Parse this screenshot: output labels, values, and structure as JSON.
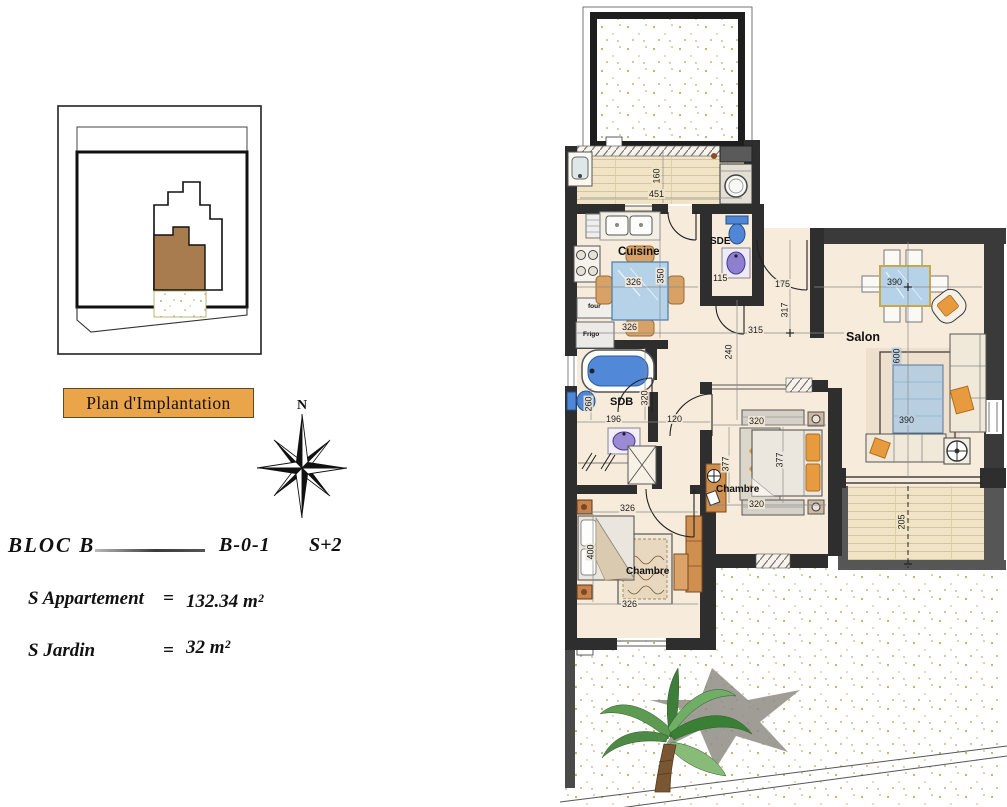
{
  "colors": {
    "caption_fill": "#EAA449",
    "wall_dark": "#2E2E2E",
    "wall_gray": "#565656",
    "floor_cream": "#F7ECDB",
    "deck_tan": "#F1E4C6",
    "water_blue": "#4F86D6",
    "glass_blue": "#B5D2E8",
    "wood_orange": "#CF8F4F",
    "cushion_orange": "#E79B3E",
    "fixture_lavender": "#9A8BD4",
    "siteplan_brown": "#A87C4E",
    "leaf_green": "#4C8A45"
  },
  "site_plan": {
    "caption": "Plan d'Implantation"
  },
  "compass": {
    "north": "N"
  },
  "title_block": {
    "bloc": "BLOC B",
    "unit": "B-0-1",
    "level": "S+2",
    "areas": [
      {
        "label": "S  Appartement",
        "equals": "=",
        "value": "132.34 m²"
      },
      {
        "label": "S  Jardin",
        "equals": "=",
        "value": "32 m²"
      }
    ]
  },
  "plan": {
    "room_labels": {
      "cuisine": "Cuisine",
      "sde": "SDE",
      "sdb": "SDB",
      "salon": "Salon",
      "chambre_middle": "Chambre",
      "chambre_bottom": "Chambre",
      "four": "four",
      "frigo": "Frigo"
    },
    "dims": {
      "loggia_depth": "160",
      "loggia_width": "451",
      "kitchen_table": "326",
      "kitchen_depth": "350",
      "kitchen_width": "326",
      "sde_width": "115",
      "entry_door": "175",
      "entry_depth": "317",
      "hall_width": "315",
      "hall_depth": "240",
      "sdb_wall": "320",
      "sdb_width": "196",
      "wc_height": "260",
      "corridor_width": "120",
      "salon_table": "390",
      "rug_length": "600",
      "rug_width": "390",
      "bedroom2_top": "320",
      "bedroom2_left": "377",
      "bedroom2_right": "377",
      "bedroom2_bottom": "320",
      "bedroom1_top": "326",
      "bedroom1_depth": "400",
      "bedroom1_bottom": "326",
      "terrace_depth": "205"
    }
  }
}
